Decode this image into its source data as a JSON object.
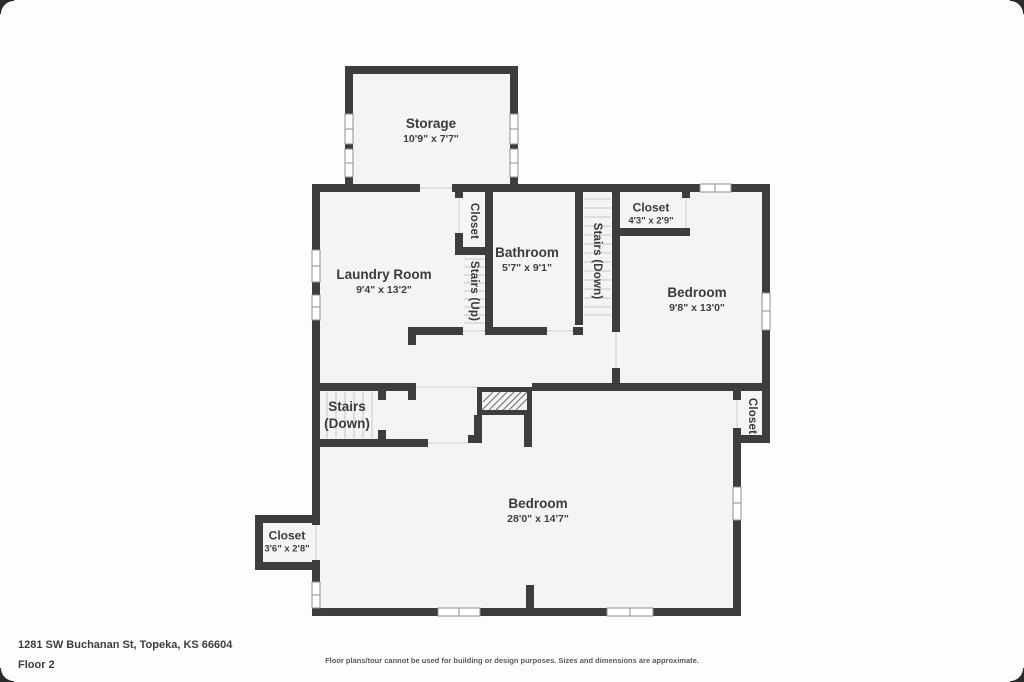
{
  "meta": {
    "address": "1281 SW Buchanan St, Topeka, KS 66604",
    "floor_label": "Floor 2",
    "disclaimer": "Floor plans/tour cannot be used for building or design purposes. Sizes and dimensions are approximate."
  },
  "colors": {
    "wall": "#3d3d3d",
    "room_fill": "#f4f4f2",
    "background": "#fdfdfc",
    "window_frame": "#8f8f8f",
    "stair_tread": "#c6c6c4",
    "text": "#3b3b3b"
  },
  "rooms": {
    "storage": {
      "name": "Storage",
      "dims": "10'9\" x 7'7\""
    },
    "laundry": {
      "name": "Laundry Room",
      "dims": "9'4\" x 13'2\""
    },
    "closet_upper": {
      "name": "Closet",
      "dims": ""
    },
    "stairs_up": {
      "name": "Stairs (Up)",
      "dims": ""
    },
    "bathroom": {
      "name": "Bathroom",
      "dims": "5'7\" x 9'1\""
    },
    "stairs_down_up": {
      "name": "Stairs (Down)",
      "dims": ""
    },
    "closet_tr": {
      "name": "Closet",
      "dims": "4'3\" x 2'9\""
    },
    "bedroom_upper": {
      "name": "Bedroom",
      "dims": "9'8\" x 13'0\""
    },
    "stairs_down_lo": {
      "name": "Stairs",
      "dims": "(Down)"
    },
    "bedroom_lower": {
      "name": "Bedroom",
      "dims": "28'0\" x 14'7\""
    },
    "closet_bl": {
      "name": "Closet",
      "dims": "3'6\" x 2'8\""
    },
    "closet_right": {
      "name": "Closet",
      "dims": ""
    }
  }
}
